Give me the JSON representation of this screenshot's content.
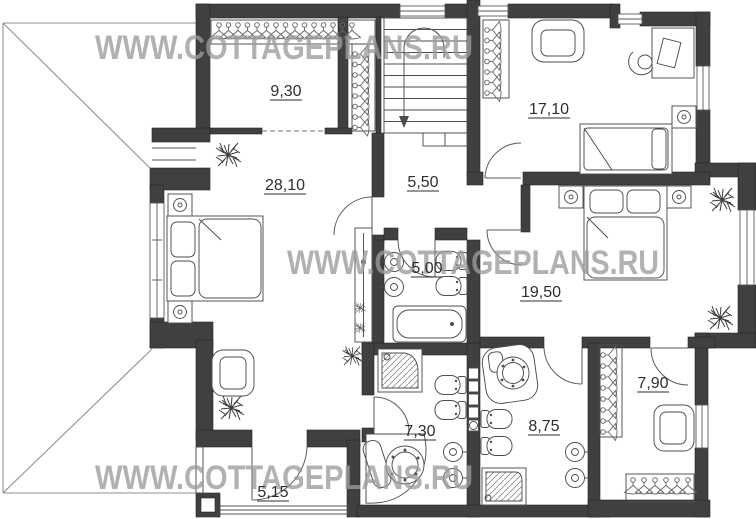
{
  "watermark": {
    "text": "WWW.COTTAGEPLANS.RU"
  },
  "rooms": [
    {
      "name": "wardrobe-top",
      "area": "9,30"
    },
    {
      "name": "bedroom-top-right",
      "area": "17,10"
    },
    {
      "name": "master-bedroom",
      "area": "28,10"
    },
    {
      "name": "hall-stairs",
      "area": "5,50"
    },
    {
      "name": "bathroom-center",
      "area": "5,00"
    },
    {
      "name": "bedroom-right",
      "area": "19,50"
    },
    {
      "name": "dressing-room-right",
      "area": "7,90"
    },
    {
      "name": "master-bathroom",
      "area": "7,30"
    },
    {
      "name": "bathroom-right",
      "area": "8,75"
    },
    {
      "name": "balcony",
      "area": "5,15"
    }
  ],
  "colors": {
    "wall": "#404040",
    "line": "#4d4d4d",
    "label": "#2e2e2e",
    "watermark": "#9c9c9c",
    "roof": "#8f8f8f",
    "bg": "#ffffff"
  }
}
